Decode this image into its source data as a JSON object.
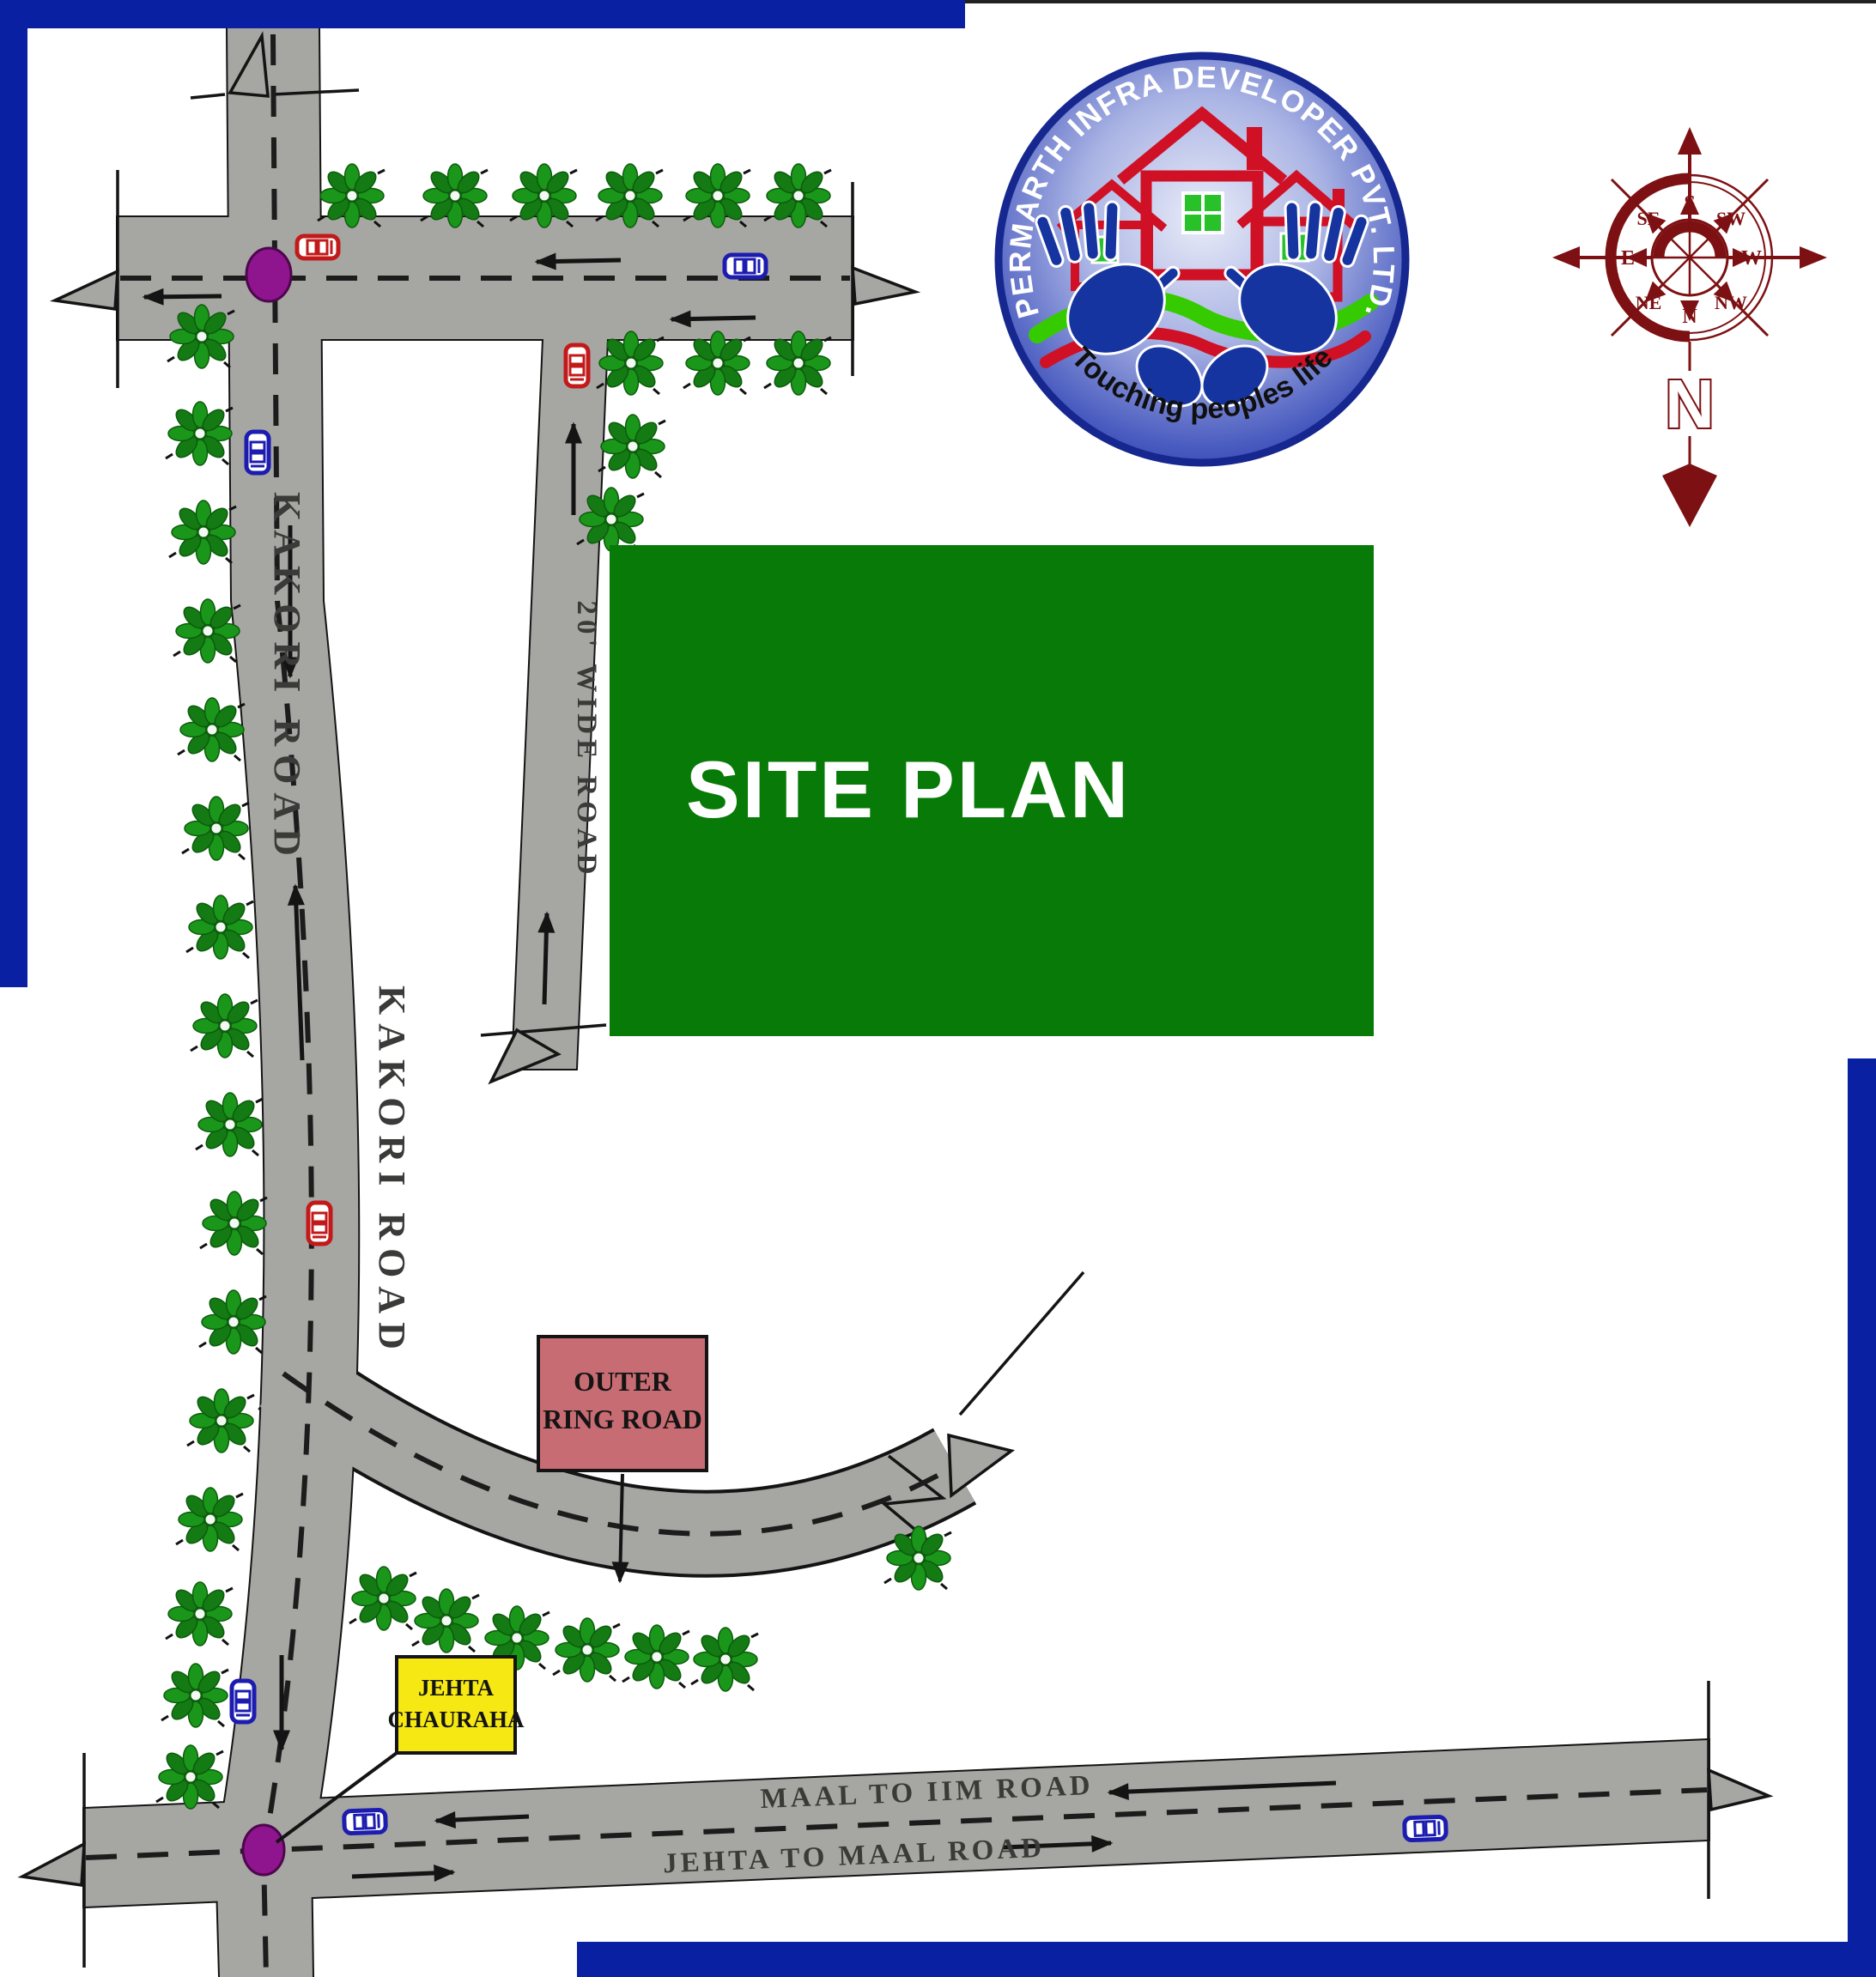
{
  "banner": {
    "label": "SITE PLAN",
    "bg": "#077a07"
  },
  "logo": {
    "arc_text": "PERMARTH INFRA DEVELOPER PVT. LTD.",
    "tagline": "Touching peoples life"
  },
  "compass": {
    "top": "S",
    "top_right": "SW",
    "right": "W",
    "bottom_right": "NW",
    "bottom": "N",
    "bottom_left": "NE",
    "left": "E",
    "top_left": "SE",
    "pole_letter": "N",
    "color": "#7d1012"
  },
  "roads": {
    "surface_color": "#a6a6a2",
    "kakori_upper_label": "KAKORI ROAD",
    "kakori_lower_label": "KAKORI ROAD",
    "wide_road_label": "20' WIDE ROAD",
    "maal_to_iim_label": "MAAL TO IIM ROAD",
    "jehta_to_maal_label": "JEHTA TO MAAL ROAD"
  },
  "callouts": {
    "outer_ring_road": {
      "line1": "OUTER",
      "line2": "RING ROAD",
      "bg": "#c76c73"
    },
    "jehta_chauraha": {
      "line1": "JEHTA",
      "line2": "CHAURAHA",
      "bg": "#f6e913"
    }
  },
  "markers": {
    "intersection_color": "#8e158e",
    "tree_color": "#1a961a",
    "car_blue": "#1c1cb0",
    "car_red": "#c21a1a",
    "frame_blue": "#0a20a2"
  }
}
